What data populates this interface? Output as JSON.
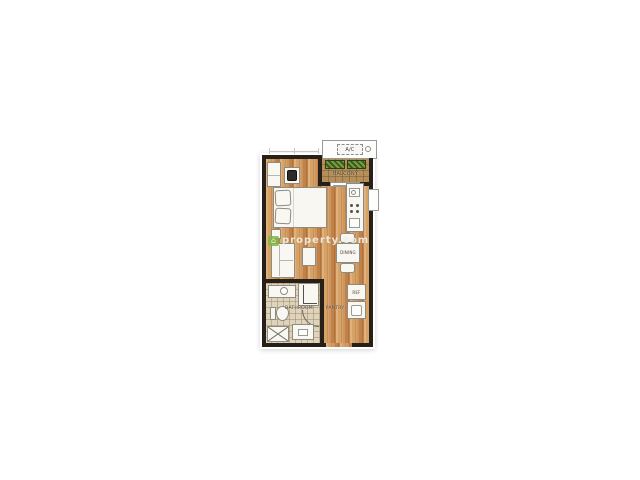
{
  "plan": {
    "labels": {
      "ac": "A/C",
      "balcony": "BALCONY",
      "dining": "DINING",
      "bathroom": "BATHROOM",
      "pantry": "PANTRY",
      "ref": "REF"
    },
    "watermark": {
      "text": "property.com"
    },
    "colors": {
      "wall": "#262019",
      "furn": "#f8f7f2",
      "furn_border": "#8f8b80",
      "wood_a": "#d9a265",
      "wood_b": "#c28147",
      "tile": "#ded3bc",
      "balcony_tile": "#b68f58",
      "plant_dark": "#41591f",
      "plant_light": "#72a03e",
      "label_text": "#453c28",
      "watermark_green": "#7db843",
      "arc": "#6f675a"
    }
  }
}
